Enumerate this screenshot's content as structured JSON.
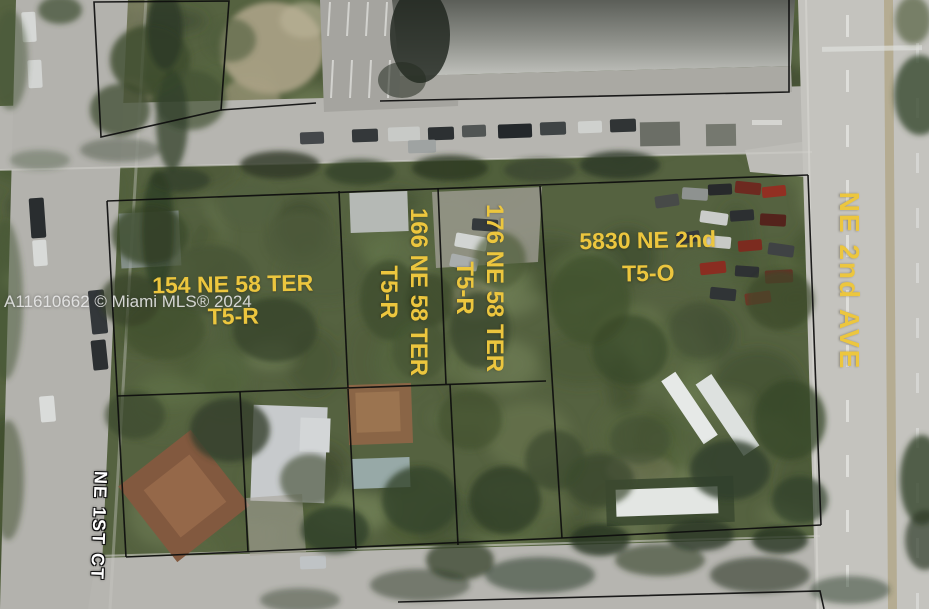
{
  "image_type": "aerial-parcel-listing-photo",
  "watermark": "A11610662 © Miami MLS® 2024",
  "parcel_labels": [
    {
      "address": "154 NE 58 TER",
      "zoning": "T5-R",
      "orientation": "horizontal"
    },
    {
      "address": "166 NE 58 TER",
      "zoning": "T5-R",
      "orientation": "vertical"
    },
    {
      "address": "176 NE 58 TER",
      "zoning": "T5-R",
      "orientation": "vertical"
    },
    {
      "address": "5830 NE 2nd",
      "zoning": "T5-O",
      "orientation": "horizontal"
    }
  ],
  "street_labels": [
    {
      "name": "NE 2nd AVE",
      "style": "yellow",
      "orientation": "vertical"
    },
    {
      "name": "NE 1ST CT",
      "style": "white-outlined",
      "orientation": "vertical"
    }
  ],
  "colors": {
    "label_yellow": "#ECC63E",
    "street_label_white": "#FFFFFF",
    "watermark_gray": "#EBEBEB",
    "parcel_line_black": "#0D0D0D",
    "road_gray": "#B6B5B0",
    "avenue_gray": "#C4C3BE",
    "vegetation_green": "#556240",
    "roof_brown": "#82593F",
    "roof_gray": "#C7CACC"
  }
}
